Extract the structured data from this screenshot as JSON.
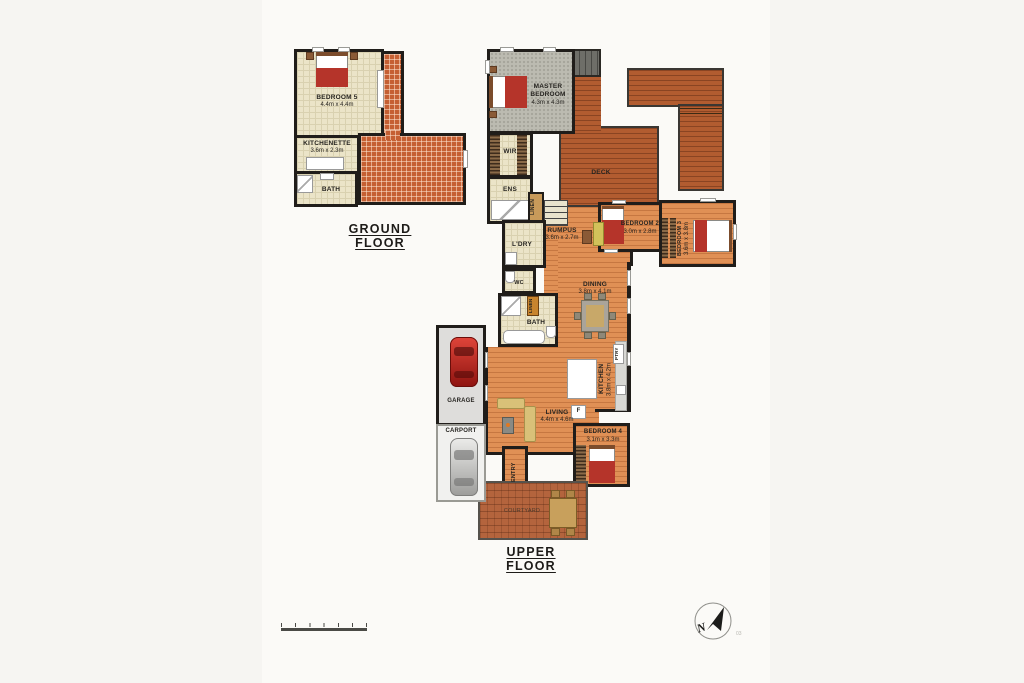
{
  "titles": {
    "ground": "GROUND FLOOR",
    "upper": "UPPER FLOOR"
  },
  "ground": {
    "bedroom5": {
      "name": "BEDROOM 5",
      "dims": "4.4m x 4.4m"
    },
    "kitchenette": {
      "name": "KITCHENETTE",
      "dims": "3.6m x 2.3m"
    },
    "bath": {
      "name": "BATH"
    }
  },
  "upper": {
    "master": {
      "name": "MASTER BEDROOM",
      "dims": "4.3m x 4.3m"
    },
    "wir": {
      "name": "WIR"
    },
    "ens": {
      "name": "ENS"
    },
    "linen": {
      "name": "LINEN"
    },
    "linen2": {
      "name": "LINEN"
    },
    "deck": {
      "name": "DECK"
    },
    "rumpus": {
      "name": "RUMPUS",
      "dims": "3.6m x 2.7m"
    },
    "bedroom2": {
      "name": "BEDROOM 2",
      "dims": "3.0m x 2.8m"
    },
    "bedroom3": {
      "name": "BEDROOM 3",
      "dims": "3.6m x 3.8m"
    },
    "ldry": {
      "name": "L'DRY"
    },
    "wc": {
      "name": "WC"
    },
    "bath": {
      "name": "BATH"
    },
    "dining": {
      "name": "DINING",
      "dims": "3.8m x 4.1m"
    },
    "kitchen": {
      "name": "KITCHEN",
      "dims": "3.8m x 4.2m"
    },
    "ptry": {
      "name": "PTRY"
    },
    "fridge": {
      "name": "F"
    },
    "living": {
      "name": "LIVING",
      "dims": "4.4m x 4.6m"
    },
    "bedroom4": {
      "name": "BEDROOM 4",
      "dims": "3.1m x 3.3m"
    },
    "entry": {
      "name": "ENTRY"
    },
    "garage": {
      "name": "GARAGE"
    },
    "carport": {
      "name": "CARPORT"
    },
    "courtyard": {
      "name": "COURTYARD"
    }
  },
  "compass": {
    "letter": "N",
    "watermark": "03"
  },
  "colors": {
    "wall": "#201d1a",
    "terracotta": "#c55f33",
    "wood": "#e09055",
    "deck": "#b25c30",
    "tile": "#ebe4c8",
    "carpet": "#bcbbb1",
    "bed_red": "#b5342a",
    "car_red": "#c32a20"
  }
}
